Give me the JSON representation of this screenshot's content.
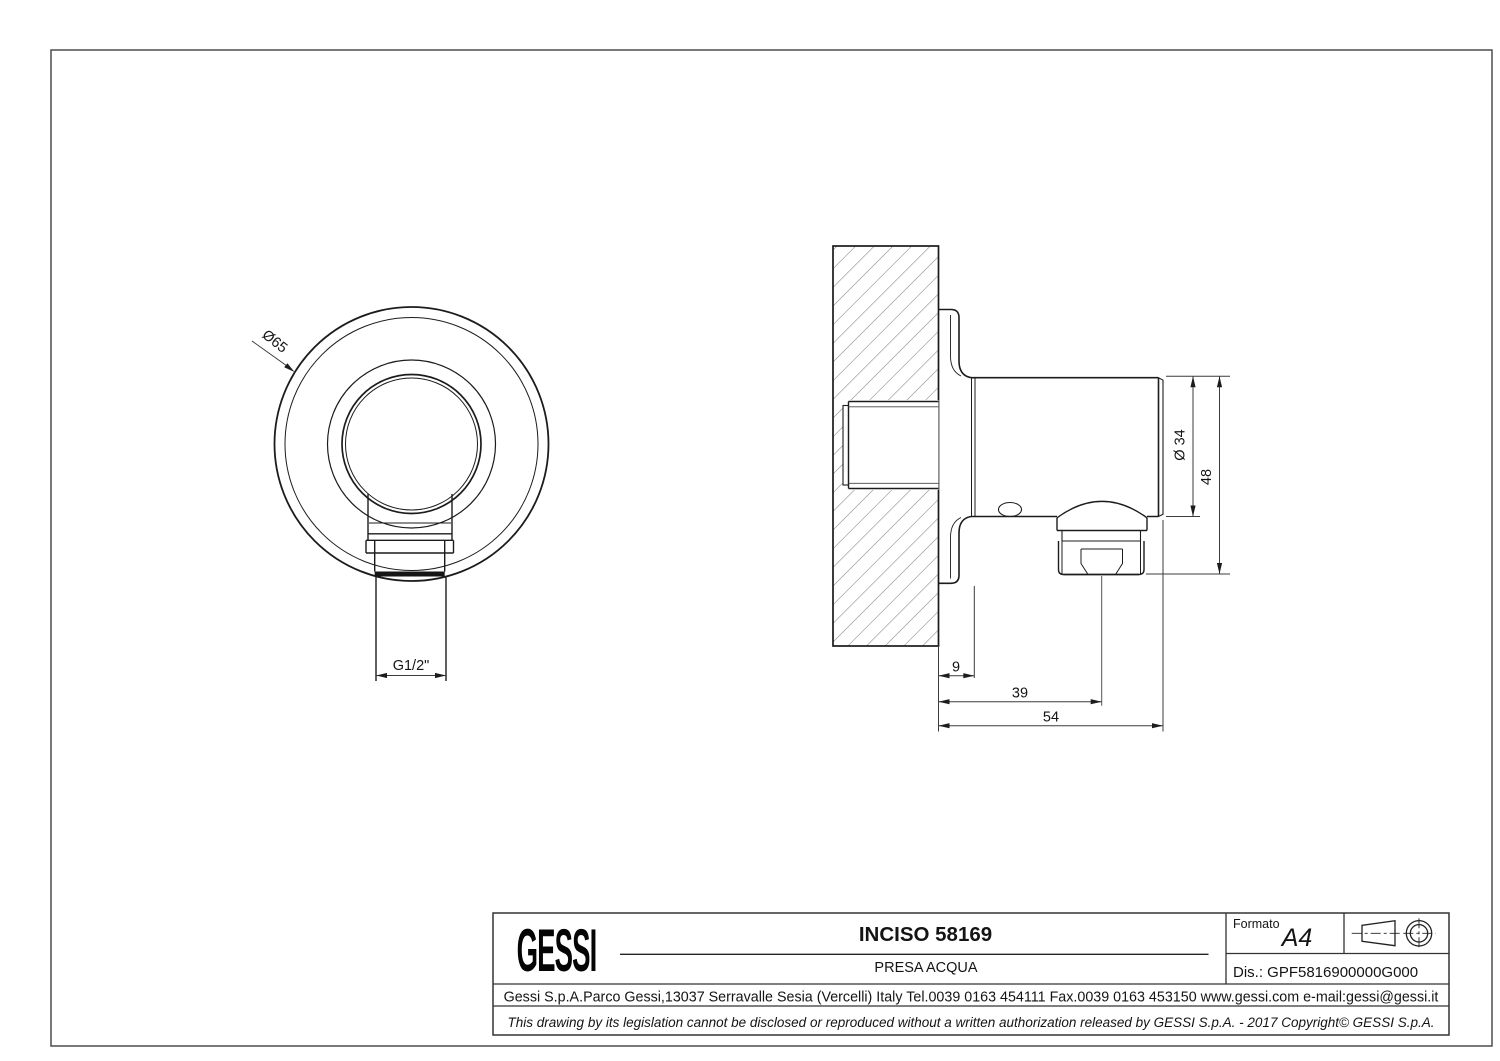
{
  "front_view": {
    "diameter_label": "Ø65",
    "thread_label": "G1/2\""
  },
  "side_view": {
    "diameter_label": "Ø 34",
    "height_label": "48",
    "wall_offset_label": "9",
    "outlet_center_label": "39",
    "total_depth_label": "54"
  },
  "title_block": {
    "logo_text": "GESSI",
    "title": "INCISO 58169",
    "subtitle": "PRESA ACQUA",
    "format_label": "Formato",
    "format_value": "A4",
    "drawing_number": "Dis.: GPF5816900000G000",
    "company_line": "Gessi S.p.A.Parco Gessi,13037 Serravalle Sesia (Vercelli) Italy Tel.0039 0163 454111 Fax.0039 0163 453150 www.gessi.com e-mail:gessi@gessi.it",
    "disclaimer": "This drawing by its legislation cannot be disclosed or reproduced without a written authorization released by GESSI S.p.A. - 2017 Copyright© GESSI S.p.A."
  }
}
